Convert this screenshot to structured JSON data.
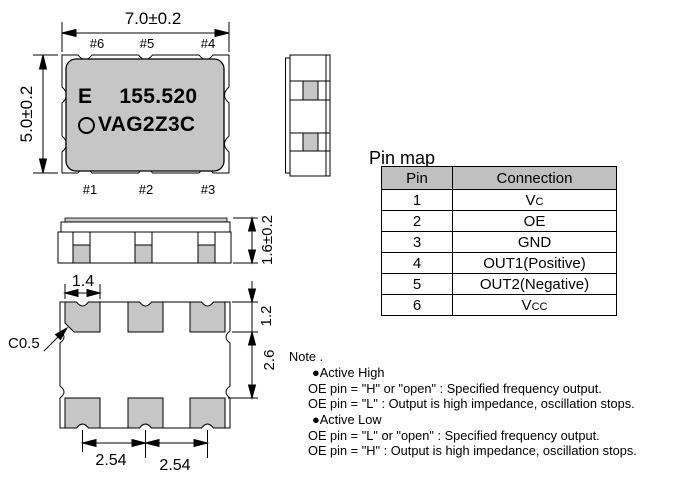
{
  "top_view": {
    "width_dim": "7.0±0.2",
    "height_dim": "5.0±0.2",
    "pins_top": [
      "#6",
      "#5",
      "#4"
    ],
    "pins_bottom": [
      "#1",
      "#2",
      "#3"
    ],
    "marking_line1_left": "E",
    "marking_line1_right": "155.520",
    "marking_line2": "VAG2Z3C"
  },
  "front_view": {
    "height_dim": "1.6±0.2",
    "pad_width_dim": "1.4"
  },
  "bottom_view": {
    "chamfer_label": "C0.5",
    "pad_height_dim": "1.2",
    "pad_gap_dim": "2.6",
    "pitch_dim_left": "2.54",
    "pitch_dim_right": "2.54"
  },
  "pin_map": {
    "title": "Pin map",
    "headers": [
      "Pin",
      "Connection"
    ],
    "rows": [
      {
        "pin": "1",
        "connection": "Vc",
        "small_suffix": true
      },
      {
        "pin": "2",
        "connection": "OE"
      },
      {
        "pin": "3",
        "connection": "GND"
      },
      {
        "pin": "4",
        "connection": "OUT1(Positive)"
      },
      {
        "pin": "5",
        "connection": "OUT2(Negative)"
      },
      {
        "pin": "6",
        "connection": "Vcc",
        "small_suffix": true
      }
    ]
  },
  "note": {
    "title": "Note .",
    "sections": [
      {
        "heading": "●Active High",
        "lines": [
          "OE pin = \"H\" or \"open\" : Specified frequency output.",
          "OE pin = \"L\" : Output is high impedance, oscillation stops."
        ]
      },
      {
        "heading": "●Active Low",
        "lines": [
          "OE pin = \"L\" or \"open\" : Specified frequency output.",
          "OE pin = \"H\" : Output is high impedance, oscillation stops."
        ]
      }
    ]
  },
  "colors": {
    "body_gray": "#c6c6c6",
    "table_header_gray": "#c0c0c0",
    "line": "#000000"
  }
}
